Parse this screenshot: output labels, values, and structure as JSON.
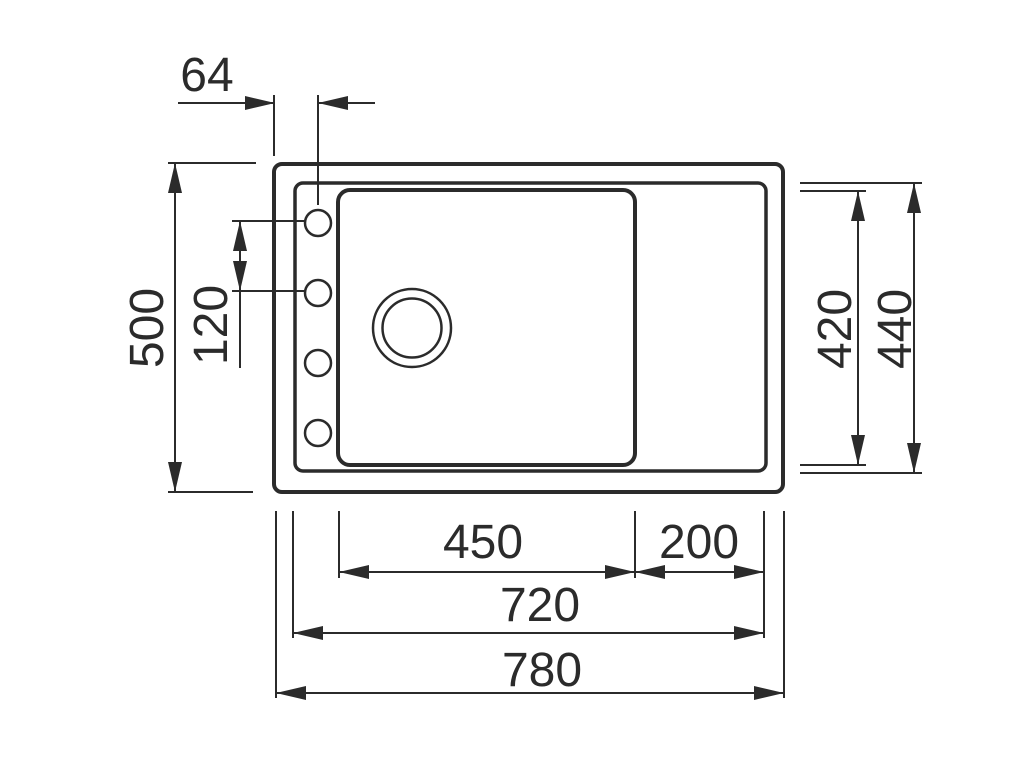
{
  "drawing": {
    "subject": "kitchen-sink-top-view-technical-drawing",
    "colors": {
      "line": "#2b2b2b",
      "background": "#ffffff"
    },
    "features": {
      "tap_holes": 4,
      "drain_rings": 2
    },
    "dimensions": {
      "hole_offset": "64",
      "overall_depth": "500",
      "hole_pitch": "120",
      "bowl_depth": "420",
      "rim_depth": "440",
      "bowl_width": "450",
      "drainer_width": "200",
      "rim_width": "720",
      "overall_width": "780"
    }
  }
}
